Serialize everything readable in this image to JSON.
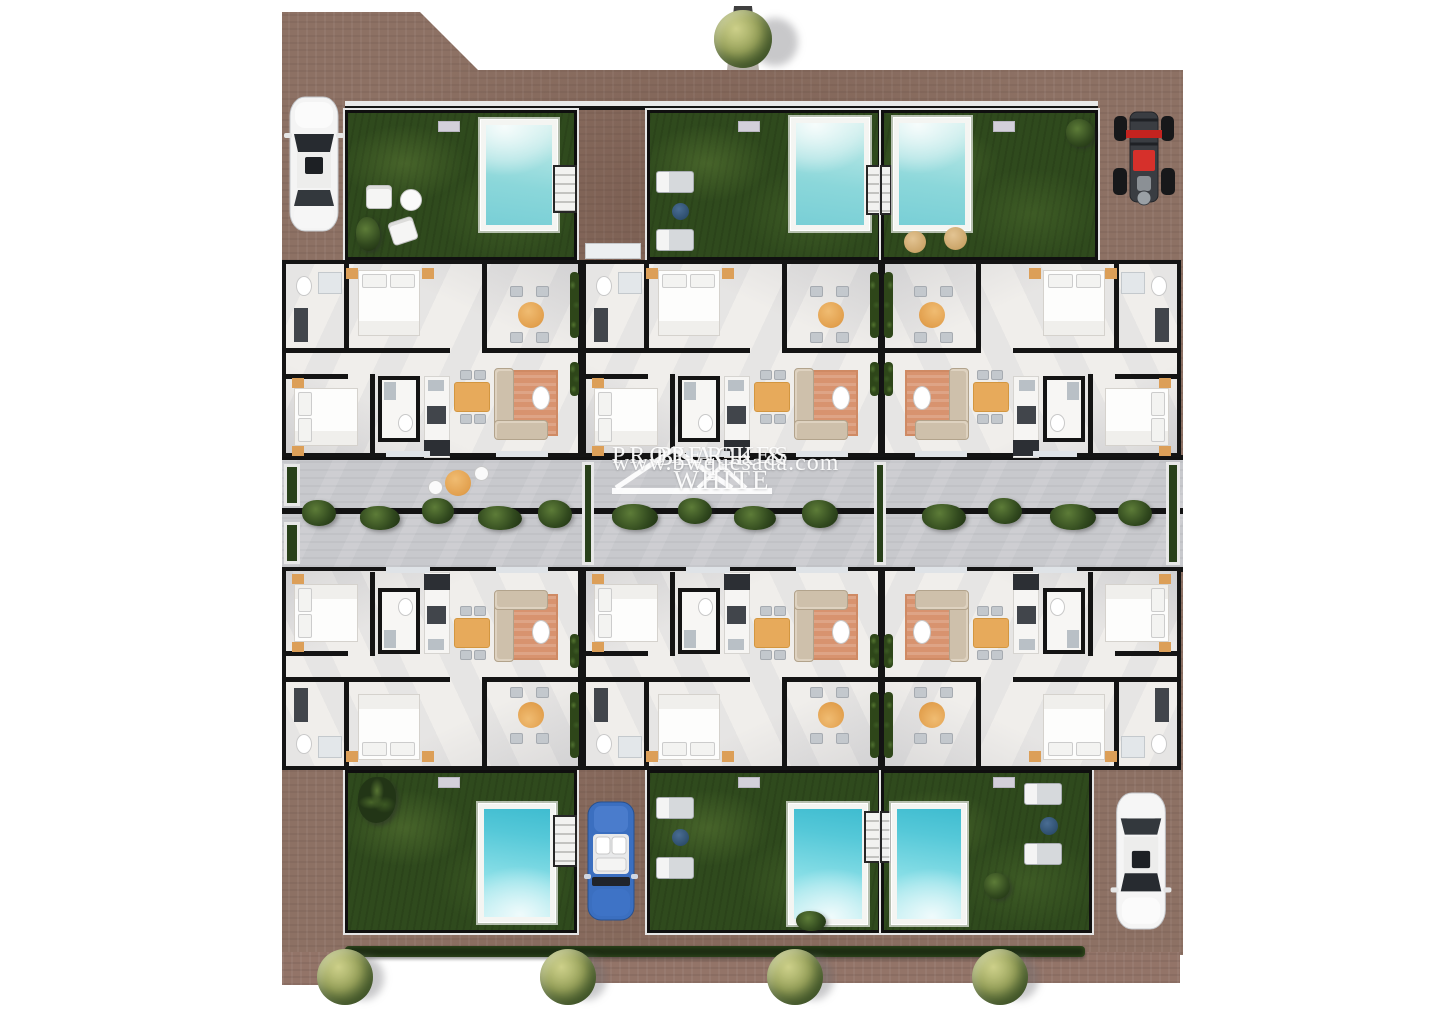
{
  "watermark": {
    "line1": "BLACK & WHITE",
    "line2": "PROPERTIES",
    "line3": "www.bwquesada.com"
  },
  "palette": {
    "brick_paving": "#8d7164",
    "grass": "#2f4a1d",
    "hedge": "#1c2c12",
    "pool_water_light": "#a9e2e2",
    "pool_water_deep": "#3fbcd0",
    "pool_deck": "#f4f5f2",
    "street_paving": "#c8c9cd",
    "wall": "#141414",
    "unit_floor": "#f0eeeb",
    "accent_orange": "#e2a04e",
    "rug_terracotta": "#d8936f",
    "tree_foliage": "#9aa45c",
    "buggy_red": "#d6302b",
    "convertible_blue": "#3b6fc0",
    "car_white": "#f4f4f4"
  },
  "scene": {
    "units_count": 6,
    "pools_count": 6,
    "trees_count": 5,
    "vehicles": [
      "white-car",
      "beach-buggy",
      "blue-convertible",
      "white-car"
    ]
  }
}
